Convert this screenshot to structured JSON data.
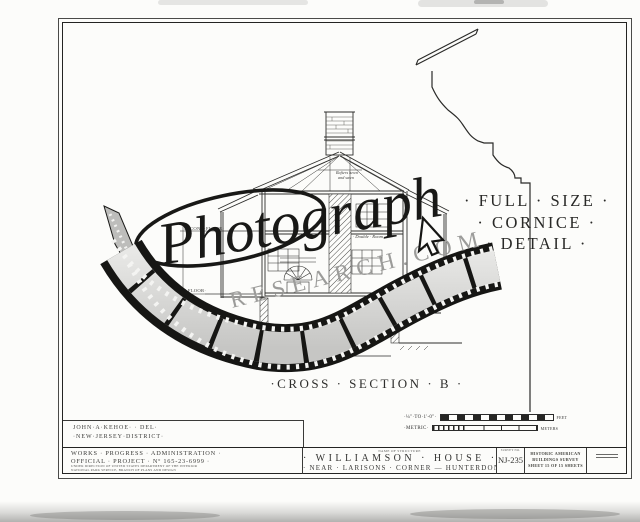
{
  "watermark": {
    "script_text": "Photograph",
    "domain_text": "RESEARCH.COM"
  },
  "captions": {
    "section": "·CROSS · SECTION · B ·",
    "cornice_line1": "· FULL · SIZE ·",
    "cornice_line2": "· CORNICE ·",
    "cornice_line3": "· DETAIL ·"
  },
  "drawing_labels": {
    "rafters_1": "Rafters hewn",
    "rafters_2": "and sawn",
    "second_floor": "SECOND·FLOOR·",
    "first_floor": "FIRST·FLOOR·",
    "double_room": "· Double · Room ·",
    "porch": "PORCH",
    "wall_thickness": "14\" Wall",
    "earth_floor": "Earth Floor"
  },
  "scales": {
    "imperial_label": "·¼\"·TO·1'-0\"·",
    "imperial_unit": "FEET",
    "metric_label": "·METRIC·",
    "metric_unit": "METERS"
  },
  "title_block": {
    "delineator_line1": "JOHN·A·KEHOE· · DEL·",
    "delineator_line2": "·NEW·JERSEY·DISTRICT·",
    "wpa_line1": "WORKS · PROGRESS · ADMINISTRATION ·",
    "wpa_line2": "OFFICIAL · PROJECT · Nº 165-23-6999 ·",
    "wpa_fine_line1": "UNDER DIRECTION OF UNITED STATES DEPARTMENT OF THE INTERIOR",
    "wpa_fine_line2": "NATIONAL PARK SERVICE, BRANCH OF PLANS AND DESIGN",
    "name_caption": "NAME OF STRUCTURE",
    "structure_name": "· WILLIAMSON · HOUSE ·",
    "structure_location": "· NEAR · LARISONS · CORNER — HUNTERDON · CO. ·",
    "survey_caption": "SURVEY NO.",
    "survey_number": "NJ-235",
    "agency_line1": "HISTORIC AMERICAN",
    "agency_line2": "BUILDINGS SURVEY",
    "agency_line3": "SHEET 15 OF 15 SHEETS"
  }
}
